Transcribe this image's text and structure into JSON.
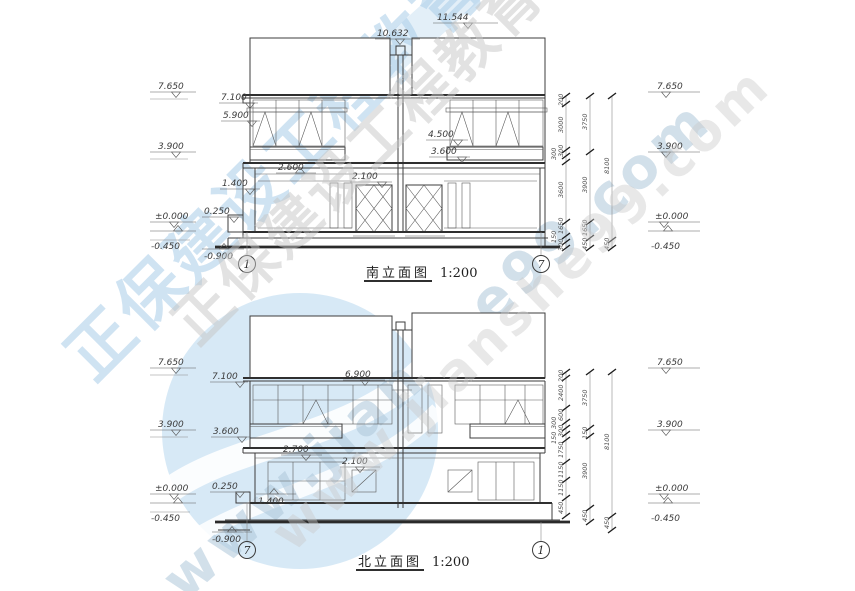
{
  "watermark": {
    "brand_cn": "正保建设工程教育网",
    "url": "www.jianshe99.com",
    "logo_color": "#b7d7ee",
    "text_blue": "#a9cde9",
    "text_gray": "#c6c6c6"
  },
  "south": {
    "title": "南立面图",
    "scale": "1:200",
    "bubble_left": "1",
    "bubble_right": "7",
    "dim_top_mid": "10.632",
    "dim_top_right": "11.544",
    "levels_left": {
      "v7650": "7.650",
      "v3900": "3.900",
      "v0": "±0.000",
      "vm450": "-0.450"
    },
    "levels_right": {
      "v7650": "7.650",
      "v3900": "3.900",
      "v0": "±0.000",
      "vm450": "-0.450"
    },
    "labels": {
      "v7100": "7.100",
      "v5900": "5.900",
      "v4500": "4.500",
      "v3600": "3.600",
      "v2600": "2.600",
      "v2100": "2.100",
      "v1400": "1.400",
      "v0250": "0.250",
      "vm900": "-0.900"
    },
    "chains": {
      "inner": [
        "200",
        "3000",
        "300",
        "300",
        "3600",
        "1650",
        "150",
        "300"
      ],
      "middle": [
        "3750",
        "3900",
        "1650",
        "450"
      ],
      "outer": [
        "8100",
        "450"
      ]
    }
  },
  "north": {
    "title": "北立面图",
    "scale": "1:200",
    "bubble_left": "7",
    "bubble_right": "1",
    "levels_left": {
      "v7650": "7.650",
      "v3900": "3.900",
      "v0": "±0.000",
      "vm450": "-0.450"
    },
    "levels_right": {
      "v7650": "7.650",
      "v3900": "3.900",
      "v0": "±0.000",
      "vm450": "-0.450"
    },
    "labels": {
      "v7100": "7.100",
      "v6900": "6.900",
      "v3600": "3.600",
      "v2700": "2.700",
      "v2100": "2.100",
      "v1400": "1.400",
      "v0250": "0.250",
      "vm900": "-0.900"
    },
    "chains": {
      "inner": [
        "200",
        "2400",
        "600",
        "300",
        "300",
        "150",
        "1750",
        "1150",
        "1150",
        "450"
      ],
      "middle": [
        "3750",
        "150",
        "3900",
        "450"
      ],
      "outer": [
        "8100",
        "450"
      ]
    }
  }
}
